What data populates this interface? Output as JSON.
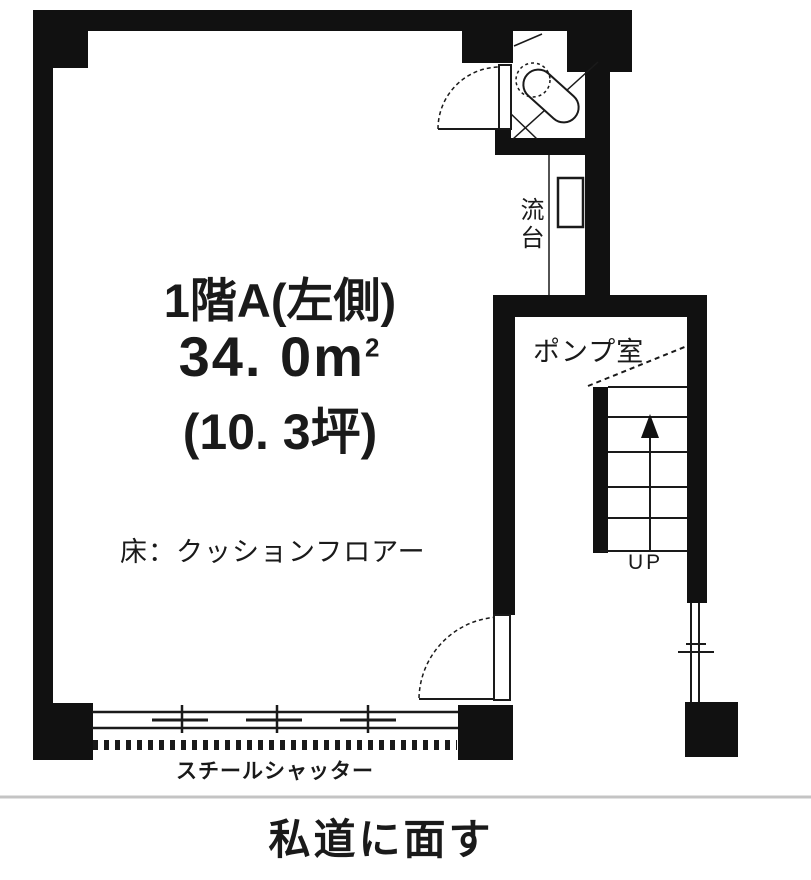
{
  "title": "floor-plan",
  "colors": {
    "wall": "#111111",
    "line": "#1a1a1a",
    "separator": "#c4c4c4",
    "background": "#ffffff"
  },
  "plan": {
    "room": {
      "name": "1階A(左側)",
      "area_m2": "34. 0m",
      "area_sup": "2",
      "area_tsubo": "(10. 3坪)",
      "floor_note": "床：クッションフロアー"
    },
    "labels": {
      "sink": "流台",
      "pump_room": "ポンプ室",
      "stairs_up": "UP",
      "shutter": "スチールシャッター",
      "road": "私道に面す"
    },
    "features": [
      "toilet-room-top-right",
      "sink-nook",
      "pump-room-with-stairs",
      "steel-shutter-storefront",
      "swing-doors"
    ]
  }
}
